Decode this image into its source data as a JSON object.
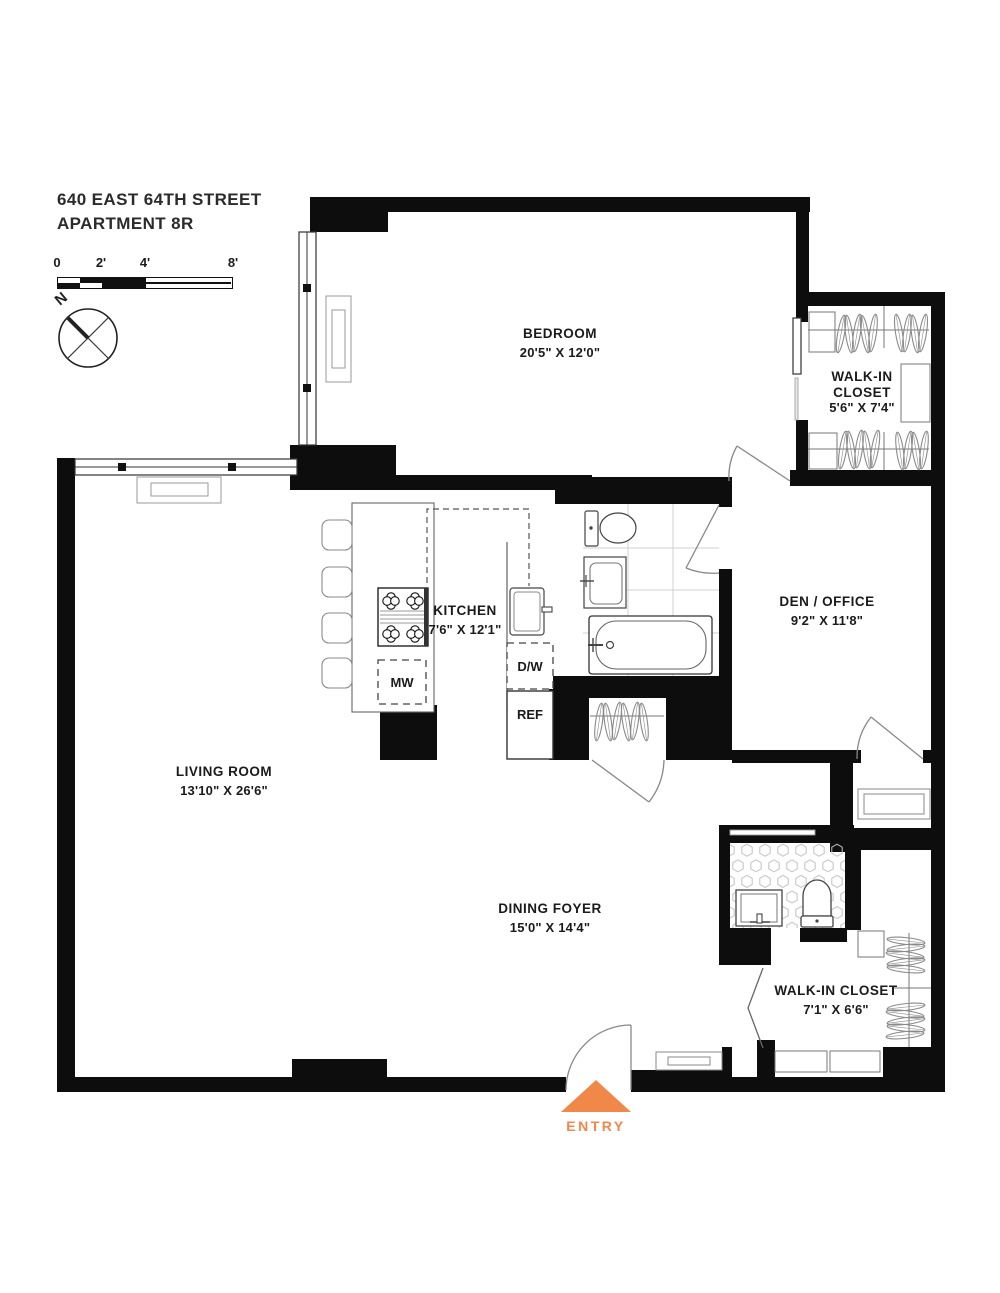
{
  "header": {
    "address": "640 EAST 64TH STREET",
    "unit": "APARTMENT 8R"
  },
  "scale_bar": {
    "ticks": [
      "0",
      "2'",
      "4'",
      "8'"
    ]
  },
  "compass": {
    "north_label": "N"
  },
  "rooms": {
    "bedroom": {
      "name": "BEDROOM",
      "dims": "20'5\" X 12'0\""
    },
    "walk_in_closet_upper": {
      "name": "WALK-IN CLOSET",
      "dims": "5'6\" X 7'4\""
    },
    "kitchen": {
      "name": "KITCHEN",
      "dims": "7'6\" X 12'1\""
    },
    "den_office": {
      "name": "DEN / OFFICE",
      "dims": "9'2\" X 11'8\""
    },
    "living_room": {
      "name": "LIVING ROOM",
      "dims": "13'10\" X 26'6\""
    },
    "dining_foyer": {
      "name": "DINING FOYER",
      "dims": "15'0\" X 14'4\""
    },
    "walk_in_closet_lower": {
      "name": "WALK-IN CLOSET",
      "dims": "7'1\" X 6'6\""
    }
  },
  "appliances": {
    "microwave": "MW",
    "dishwasher": "D/W",
    "refrigerator": "REF"
  },
  "entry": {
    "label": "ENTRY"
  },
  "colors": {
    "entry_accent": "#F0884A",
    "wall": "#0D0D0D"
  }
}
